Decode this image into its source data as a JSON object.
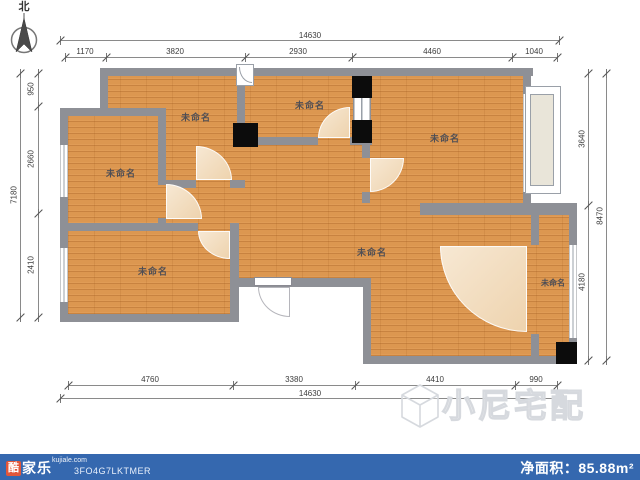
{
  "compass": {
    "label": "北"
  },
  "rooms": [
    {
      "label": "未命名"
    },
    {
      "label": "未命名"
    },
    {
      "label": "未命名"
    },
    {
      "label": "未命名"
    },
    {
      "label": "未命名"
    },
    {
      "label": "未命名"
    },
    {
      "label": "未命名"
    }
  ],
  "dims": {
    "top": {
      "total": "14630",
      "segments": [
        "1170",
        "3820",
        "2930",
        "4460",
        "1040"
      ]
    },
    "left": {
      "total": "7180",
      "segments": [
        "950",
        "2660",
        "2410"
      ]
    },
    "right": {
      "total": "8470",
      "segments": [
        "3640",
        "4180"
      ]
    },
    "bottom": {
      "total": "14630",
      "segments": [
        "4760",
        "3380",
        "4410",
        "990"
      ]
    }
  },
  "watermark": {
    "text": "小尼宅配"
  },
  "footer": {
    "brand_char": "酷",
    "brand_rest": "家乐",
    "domain": "kujiale.com",
    "code": "3FO4G7LKTMER",
    "area_label": "净面积：",
    "area_value": "85.88m²"
  },
  "colors": {
    "footer_bar": "#3568af",
    "brand_red": "#e25639",
    "floor_wood": "#dc9750",
    "wall_gray": "#8e9096",
    "pillar_black": "#0c0c0c",
    "door_arc_beige": "#eed3ae",
    "bay_fill": "#e9e5d9"
  }
}
